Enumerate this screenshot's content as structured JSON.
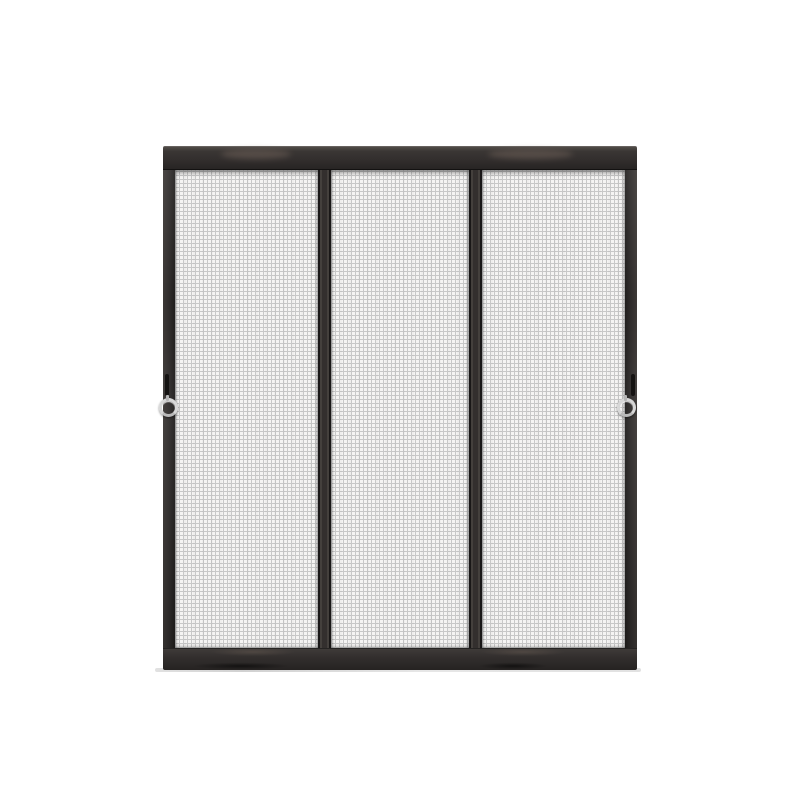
{
  "image": {
    "type": "product-photo",
    "description": "Black three-panel mesh screen door with dark charcoal aluminum frame, two vertical dividers, a small black hook latch and a silver pull ring on each inner side stile, shown on a plain white background"
  },
  "door": {
    "panel_count": 3,
    "divider_count": 2,
    "pull_ring_count": 2,
    "latch_count": 2,
    "parts": {
      "top_rail": "top-rail",
      "bottom_rail": "bottom-rail",
      "left_stile": "left-stile",
      "right_stile": "right-stile",
      "mesh_panels": [
        "mesh-panel-left",
        "mesh-panel-center",
        "mesh-panel-right"
      ],
      "hardware": [
        "latch-hook-left",
        "latch-hook-right",
        "pull-ring-left",
        "pull-ring-right"
      ]
    }
  },
  "colors": {
    "bg": "#ffffff",
    "frame-dark": "#262322",
    "frame-mid": "#332f2e",
    "frame-light": "#55504c",
    "frame-gloss": "#6e6058",
    "divider-edge": "#191717",
    "mesh-bg": "#f5f4f3",
    "mesh-line": "#c8c8c8",
    "ring-silver": "#d7d7d7",
    "track": "#dcdcdc"
  }
}
